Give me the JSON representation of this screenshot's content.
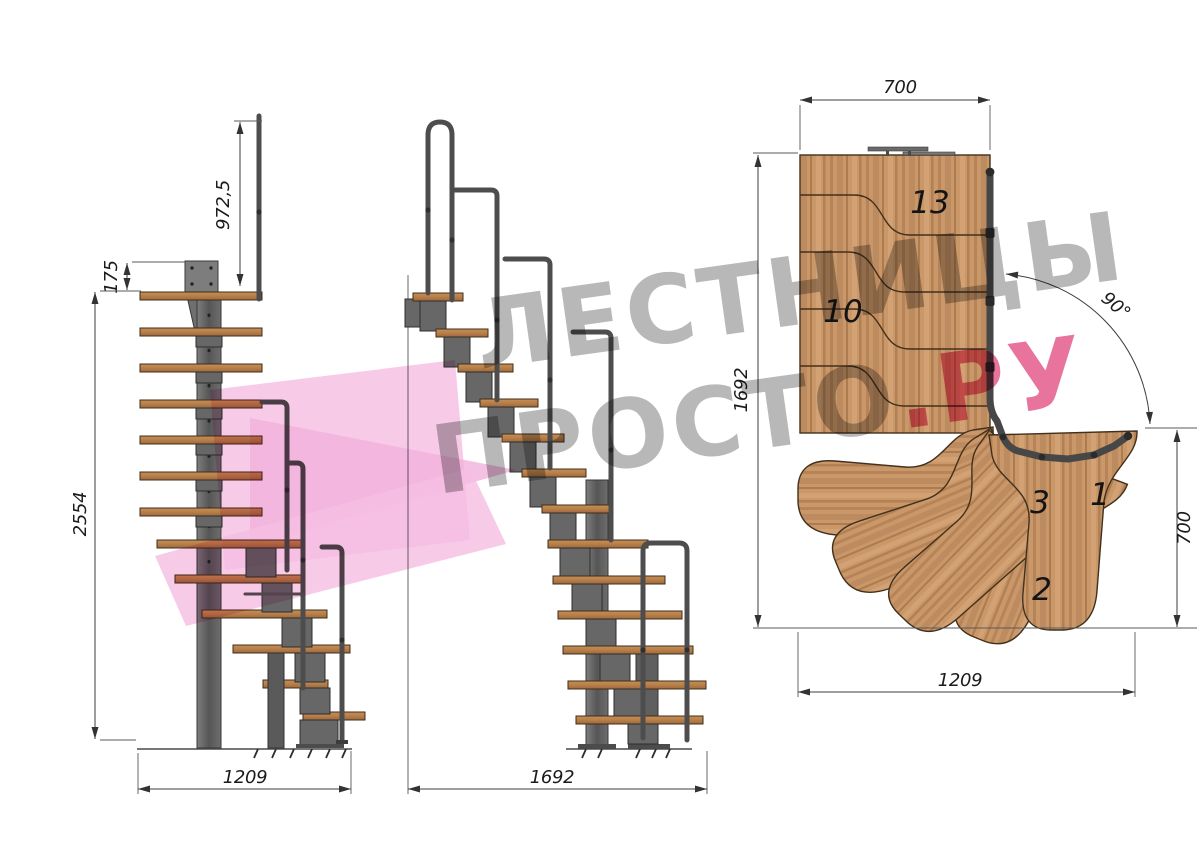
{
  "drawing": {
    "side_view": {
      "dim_rail_height": "972,5",
      "dim_plate_offset": "175",
      "dim_total_height": "2554",
      "dim_base_width": "1209"
    },
    "front_view": {
      "dim_total_width": "1692"
    },
    "plan_view": {
      "dim_top_width": "700",
      "dim_flight_length": "1692",
      "dim_turn_angle": "90°",
      "dim_right_width": "700",
      "dim_bottom_width": "1209",
      "step_labels": {
        "step13": "13",
        "step10": "10",
        "step3": "3",
        "step1": "1",
        "step2": "2"
      }
    },
    "watermark": {
      "line1": "ЛЕСТНИЦЫ",
      "line2_main": "ПРОСТО",
      "line2_accent": ".РУ"
    },
    "palette": {
      "wood": "#c99768",
      "wood_dark": "#8a5c33",
      "steel": "#676767",
      "handrail": "#4d4d4d",
      "dim_line": "#3c3c3c",
      "watermark_gray": "#a0a0a0",
      "watermark_pink": "#e0457d",
      "logo_pink": "#f5bee2"
    }
  }
}
